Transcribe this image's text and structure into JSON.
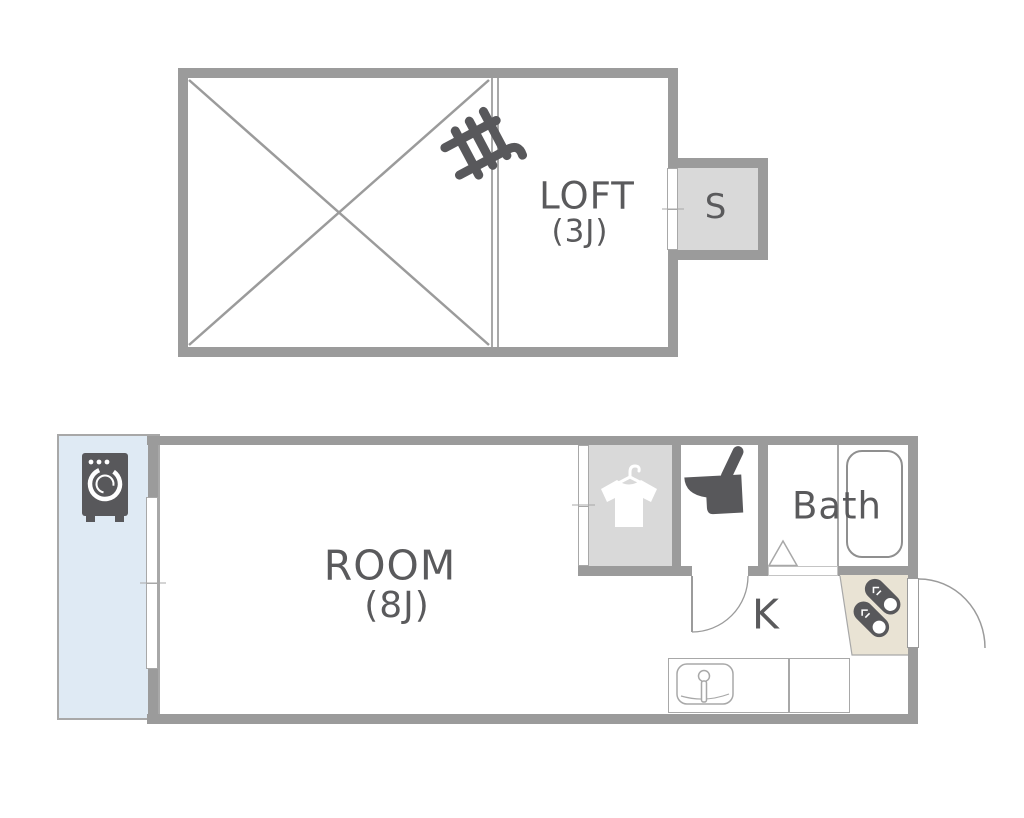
{
  "plan_title": "apartment floor plan",
  "colors": {
    "wall": "#9b9b9b",
    "thin_line": "#a8a8a8",
    "icon": "#58585b",
    "text": "#5a5a5c",
    "balcony_fill": "#dfeaf4",
    "closet_fill": "#d9d9d9",
    "genkan_fill": "#e9e3d4",
    "background": "#ffffff"
  },
  "upper_floor": {
    "room_label": "LOFT",
    "room_size": "(3J)",
    "storage_label": "S",
    "icons": {
      "ladder": "ladder-icon"
    }
  },
  "lower_floor": {
    "room_label": "ROOM",
    "room_size": "(8J)",
    "kitchen_label": "K",
    "bath_label": "Bath",
    "icons": {
      "washing_machine": "washing-machine-icon",
      "shirt_hanger": "shirt-hanger-icon",
      "toilet": "toilet-icon",
      "bathtub": "bathtub-icon",
      "shoes": "shoes-icon",
      "sink": "kitchen-sink-icon"
    }
  }
}
